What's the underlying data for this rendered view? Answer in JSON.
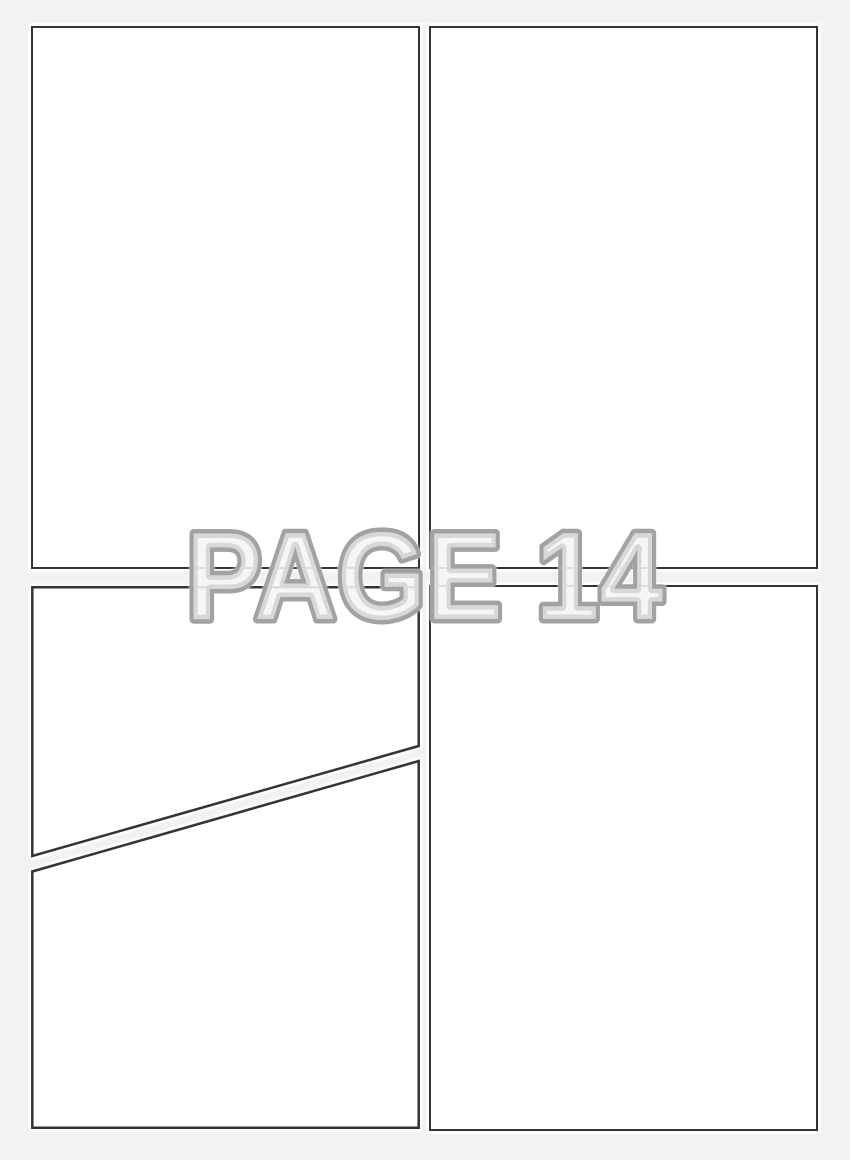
{
  "watermark": {
    "text": "PAGE 14",
    "page_number": "14"
  },
  "panels": [
    {
      "name": "top-left"
    },
    {
      "name": "top-right"
    },
    {
      "name": "bottom-left-upper"
    },
    {
      "name": "bottom-left-lower"
    },
    {
      "name": "bottom-right"
    }
  ],
  "colors": {
    "background": "#f2f2f3",
    "panel-fill": "#ffffff",
    "panel-border": "#333333",
    "panel-halo": "rgba(255,255,255,0.7)",
    "watermark-outline": "#a2a2a2",
    "watermark-fill": "rgba(242,242,244,0.68)"
  }
}
